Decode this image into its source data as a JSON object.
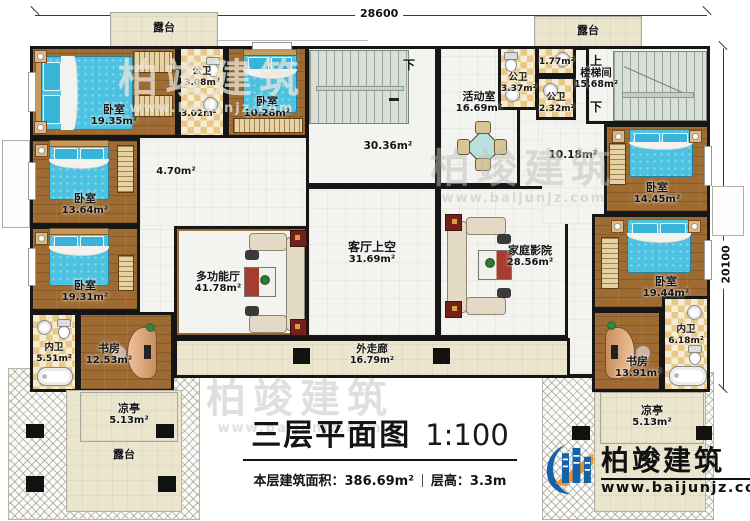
{
  "dimensions": {
    "top": "28600",
    "right": "20100"
  },
  "stair_labels": {
    "up": "上",
    "down": "下"
  },
  "rooms": {
    "terrace_top_left": {
      "name": "露台"
    },
    "terrace_top_right": {
      "name": "露台"
    },
    "terrace_bottom_left": {
      "name": "露台"
    },
    "terrace_bottom_right": {
      "name": "露台"
    },
    "bedroom_top_left": {
      "name": "卧室",
      "area": "19.35m²"
    },
    "bath_public_top": {
      "name": "公卫",
      "area": "3.08m²"
    },
    "hall_small": {
      "area": "3.02m²"
    },
    "bedroom_top_mid": {
      "name": "卧室",
      "area": "10.28m²"
    },
    "hall_left": {
      "area": "4.70m²"
    },
    "bedroom_mid_left": {
      "name": "卧室",
      "area": "13.64m²"
    },
    "bedroom_low_left": {
      "name": "卧室",
      "area": "19.31m²"
    },
    "bath_inner_left": {
      "name": "内卫",
      "area": "5.51m²"
    },
    "study_left": {
      "name": "书房",
      "area": "12.53m²"
    },
    "pavilion_left": {
      "name": "凉亭",
      "area": "5.13m²"
    },
    "multi_hall": {
      "name": "多功能厅",
      "area": "41.78m²"
    },
    "living_void": {
      "name": "客厅上空",
      "area": "31.69m²"
    },
    "corridor_upper": {
      "area": "30.36m²"
    },
    "activity_room": {
      "name": "活动室",
      "area": "16.69m²"
    },
    "bath_public_a": {
      "name": "公卫",
      "area": "3.37m²"
    },
    "bath_small": {
      "area": "1.77m²"
    },
    "bath_public_b": {
      "name": "公卫",
      "area": "2.32m²"
    },
    "stairwell": {
      "name": "楼梯间",
      "area": "15.68m²"
    },
    "hall_right": {
      "area": "10.18m²"
    },
    "home_theater": {
      "name": "家庭影院",
      "area": "28.56m²"
    },
    "outer_corridor": {
      "name": "外走廊",
      "area": "16.79m²"
    },
    "bedroom_top_right": {
      "name": "卧室",
      "area": "14.45m²"
    },
    "bedroom_low_right": {
      "name": "卧室",
      "area": "19.44m²"
    },
    "bath_inner_right": {
      "name": "内卫",
      "area": "6.18m²"
    },
    "study_right": {
      "name": "书房",
      "area": "13.91m²"
    },
    "pavilion_right": {
      "name": "凉亭",
      "area": "5.13m²"
    }
  },
  "title_block": {
    "title": "三层平面图",
    "scale": "1:100",
    "area_text": "本层建筑面积：386.69m²",
    "height_text": "层高：3.3m"
  },
  "brand": {
    "name": "柏竣建筑",
    "website": "www.baijunjz.com"
  },
  "watermark": {
    "name": "柏竣建筑",
    "website": "www.baijunjz.com"
  },
  "colors": {
    "wall": "#161616",
    "wood_floor": "#9e6c33",
    "tile": "#e7c887",
    "terrace": "#eae5cc",
    "stair": "#d8dfd6",
    "bed": "#4cc2e0",
    "brand_blue": "#1661a8",
    "brand_orange": "#f7941d"
  }
}
